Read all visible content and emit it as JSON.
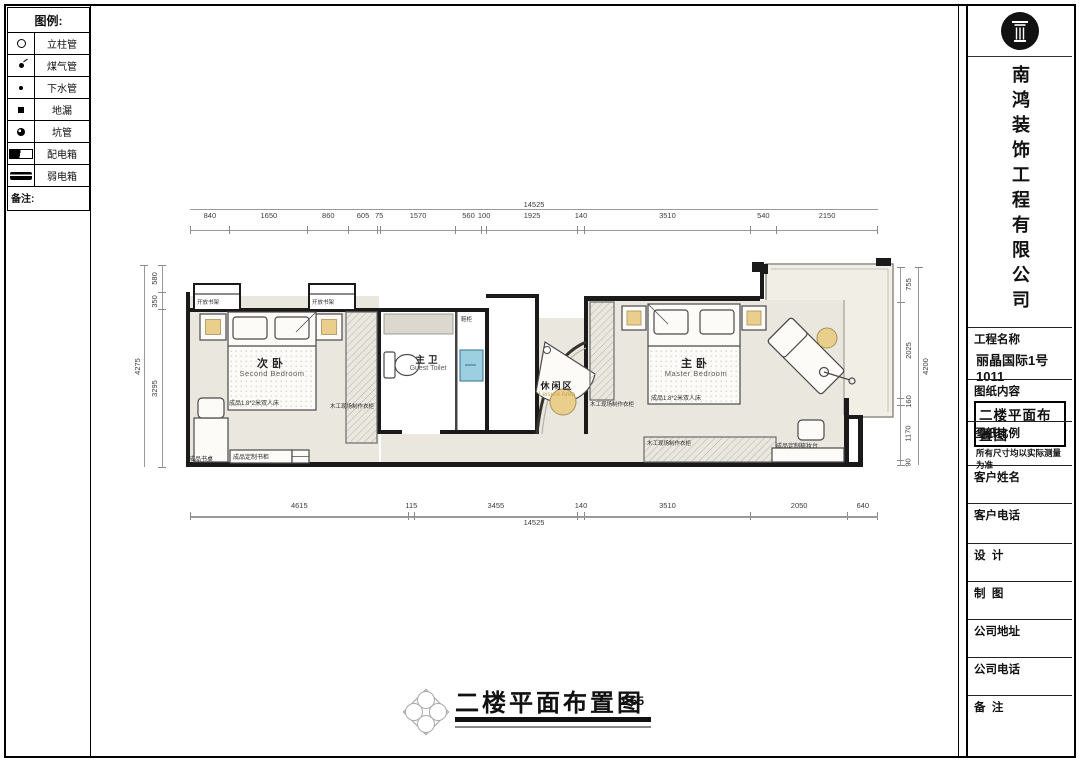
{
  "legend": {
    "title": "图例:",
    "items": [
      {
        "name": "立柱管",
        "symbol": "column-pipe"
      },
      {
        "name": "煤气管",
        "symbol": "gas-pipe"
      },
      {
        "name": "下水管",
        "symbol": "drain-pipe"
      },
      {
        "name": "地漏",
        "symbol": "floor-drain"
      },
      {
        "name": "坑管",
        "symbol": "pit-pipe"
      },
      {
        "name": "配电箱",
        "symbol": "distribution-box"
      },
      {
        "name": "弱电箱",
        "symbol": "low-voltage-box"
      }
    ],
    "note_label": "备注:"
  },
  "title_block": {
    "company": "南鸿装饰工程有限公司",
    "project_label": "工程名称",
    "project_value": "丽晶国际1号1011",
    "content_label": "图纸内容",
    "content_value": "二楼平面布置图",
    "scale_label": "图纸比例",
    "scale_note": "所有尺寸均以实际测量为准",
    "client_name_label": "客户姓名",
    "client_phone_label": "客户电话",
    "design_label": "设  计",
    "draft_label": "制  图",
    "company_address_label": "公司地址",
    "company_phone_label": "公司电话",
    "remark_label": "备  注"
  },
  "drawing_title": {
    "text": "二楼平面布置图",
    "scale": "1:55"
  },
  "plan": {
    "rooms": {
      "second_bedroom": {
        "cn": "次卧",
        "en": "Second Bedroom"
      },
      "guest_toilet": {
        "cn": "主卫",
        "en": "Guest Toilet"
      },
      "leisure_area": {
        "cn": "休闲区",
        "en": "Leisure Area"
      },
      "master_bedroom": {
        "cn": "主卧",
        "en": "Master Bedroom"
      }
    },
    "furniture_labels": {
      "open_bookshelf": "开放书架",
      "double_bed": "成品1.8*2米双人床",
      "site_made_wardrobe": "木工现场制作衣柜",
      "desk": "成品书桌",
      "custom_bookcase": "成品定制书柜",
      "custom_dresser": "成品定制梳妆台",
      "shoe_cabinet": "鞋柜"
    },
    "dimensions": {
      "top": {
        "total": 14525,
        "segments": [
          840,
          1650,
          860,
          605,
          75,
          1570,
          560,
          100,
          1925,
          140,
          3510,
          540,
          2150
        ]
      },
      "bottom": {
        "total": 14525,
        "segments": [
          4615,
          115,
          3455,
          140,
          3510,
          2050,
          640
        ]
      },
      "left": {
        "total": 4275,
        "segments": [
          580,
          350,
          3295
        ]
      },
      "right": {
        "total": 4200,
        "segments": [
          755,
          2025,
          160,
          1170,
          90
        ]
      }
    }
  }
}
